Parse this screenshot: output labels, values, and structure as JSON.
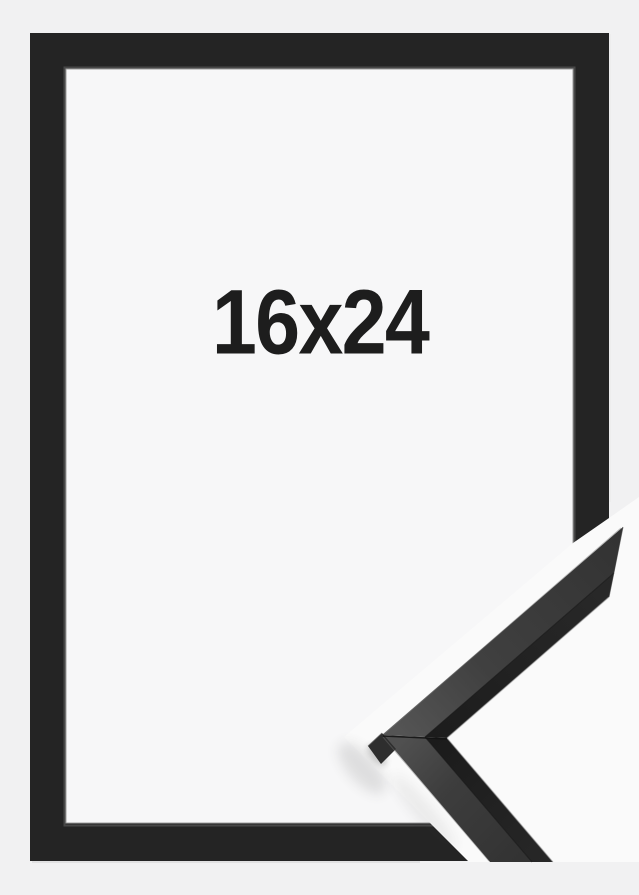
{
  "product": {
    "size_label": "16x24"
  },
  "scene": {
    "subject": "black picture frame product photo",
    "detail_view": "corner-sample of frame moulding overlaid at bottom right"
  },
  "colors": {
    "background": "#f1f1f2",
    "frame": "#242424",
    "interior": "#f7f7f8",
    "overlay_backdrop": "#fafafa",
    "moulding_top_face": "#3f3f3f",
    "moulding_front_face": "#212121",
    "label_text": "#1d1d1d"
  }
}
